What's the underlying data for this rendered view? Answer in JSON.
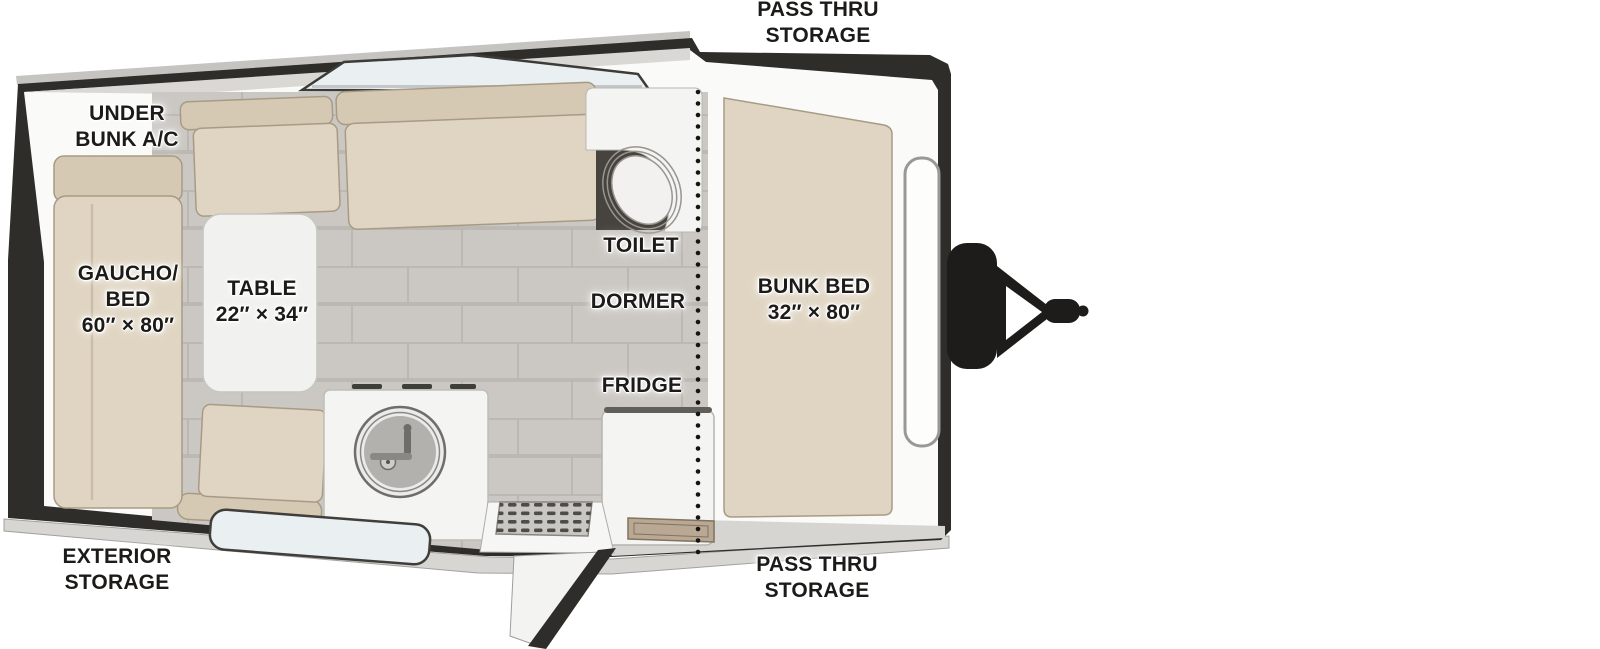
{
  "figure": {
    "type": "rv-travel-trailer-floorplan"
  },
  "labels": {
    "pass_thru_storage_top": "PASS THRU\nSTORAGE",
    "under_bunk_ac": "UNDER\nBUNK A/C",
    "gaucho_bed": "GAUCHO/\nBED\n60″ × 80″",
    "table": "TABLE\n22″ × 34″",
    "toilet": "TOILET",
    "dormer": "DORMER",
    "fridge": "FRIDGE",
    "bunk_bed": "BUNK BED\n32″ × 80″",
    "exterior_storage": "EXTERIOR\nSTORAGE",
    "pass_thru_storage_bottom": "PASS THRU\nSTORAGE"
  },
  "dimensions": {
    "gaucho_bed": "60″ × 80″",
    "table": "22″ × 34″",
    "bunk_bed": "32″ × 80″"
  },
  "colors": {
    "shell": "#2e2d2a",
    "roof_strip": "#d9d8d5",
    "roof_overhang": "#c6c4c0",
    "white_surface": "#fafaf8",
    "fixture_white": "#f4f4f2",
    "cushion": "#e0d5c2",
    "cushion_dark": "#d5c9b3",
    "floor_tile": "#cbc8c3",
    "floor_grout": "#b7b4af",
    "window_glass": "#eaeff1",
    "skirt": "#d8d6d2",
    "hitch_black": "#1d1c1a",
    "toilet_well": "#474440",
    "tray_brown": "#b9a894",
    "label_text": "#1c1b19"
  },
  "features": [
    "gaucho-bed",
    "dinette-table",
    "dinette-benches",
    "sink",
    "sink-cabinet",
    "toilet",
    "fridge",
    "bunk-bed",
    "dormer-line",
    "entry-door",
    "entry-step",
    "skylight-window",
    "front-window",
    "bottom-window",
    "under-bunk-ac-unit",
    "pass-thru-storage",
    "exterior-storage",
    "propane-tank-cover",
    "a-frame-hitch"
  ]
}
